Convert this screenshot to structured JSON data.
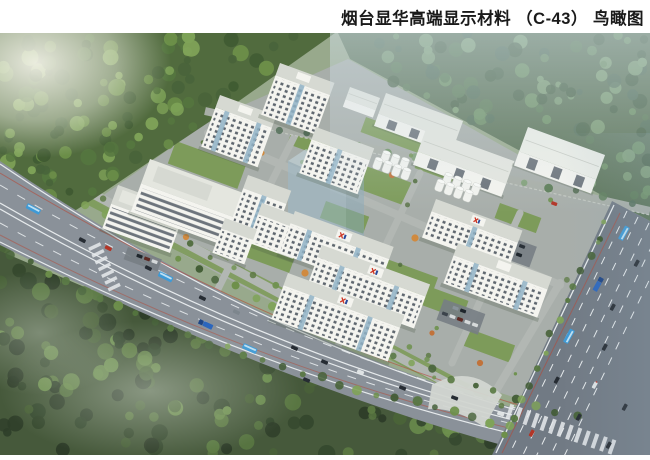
{
  "header": {
    "title": "烟台显华高端显示材料 （C-43） 鸟瞰图"
  },
  "palette": {
    "page_bg": "#ffffff",
    "title_text": "#1a1a1a",
    "base_green": "#9ab187",
    "campus_ground": "#a8aeaa",
    "lawn_green": "#7d9b5a",
    "road_asphalt": "#8a9199",
    "highway_asphalt": "#717a84",
    "lane_marking": "#e6eaec",
    "lane_red": "#b44a38",
    "building_wall": "#f4f4ef",
    "building_roof": "#d6d9d2",
    "building_roof_light": "#e4e6df",
    "building_window": "#39434f",
    "glass_blue": "#8fb2c5",
    "tank_white": "#f2f3ef",
    "logo_red": "#cc3524",
    "logo_blue": "#2b4a9b",
    "bus_blue": "#3e9ad6",
    "truck_blue": "#2b66bd"
  }
}
